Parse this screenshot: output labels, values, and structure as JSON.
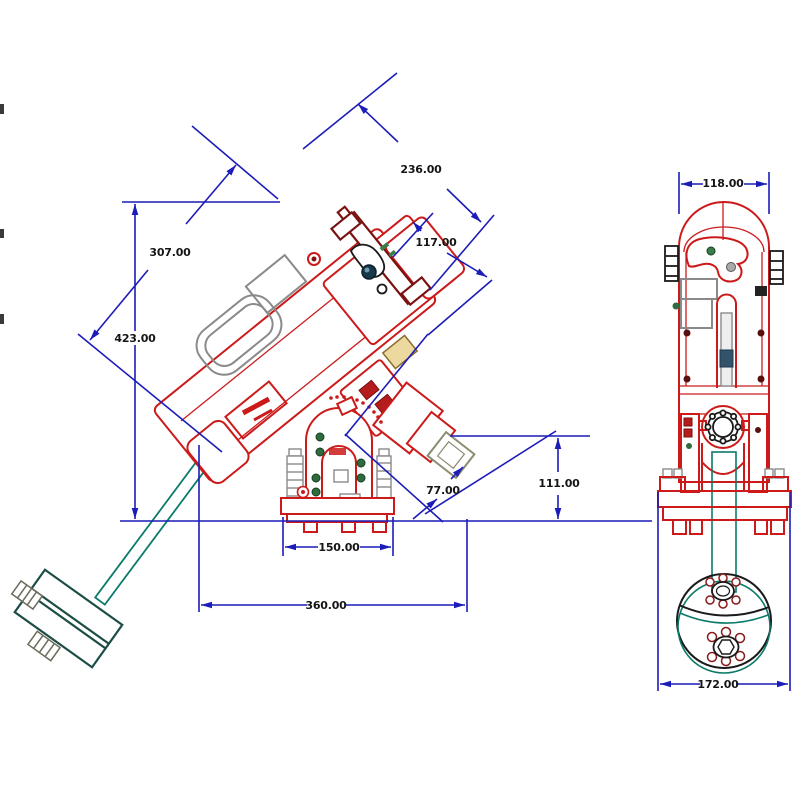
{
  "drawing": {
    "kind": "cad-dimensioned-drawing",
    "subject": "equatorial telescope mount with counterweights",
    "background": "#ffffff"
  },
  "side_view": {
    "name": "side view",
    "dim_labels": [
      "236.00",
      "117.00",
      "307.00",
      "423.00",
      "111.00",
      "77.00",
      "150.00",
      "360.00"
    ]
  },
  "front_view": {
    "name": "front view",
    "dim_labels": [
      "118.00",
      "172.00"
    ]
  },
  "colors": {
    "outline_red": "#cc1a1a",
    "saddle_dark_red": "#7a1212",
    "dimension_blue": "#1c1cb8",
    "counterweight_teal": "#0c7a6a",
    "counterweight_dark": "#1b4d45",
    "hardware_gray": "#8a8a8a",
    "label_text": "#151515"
  }
}
